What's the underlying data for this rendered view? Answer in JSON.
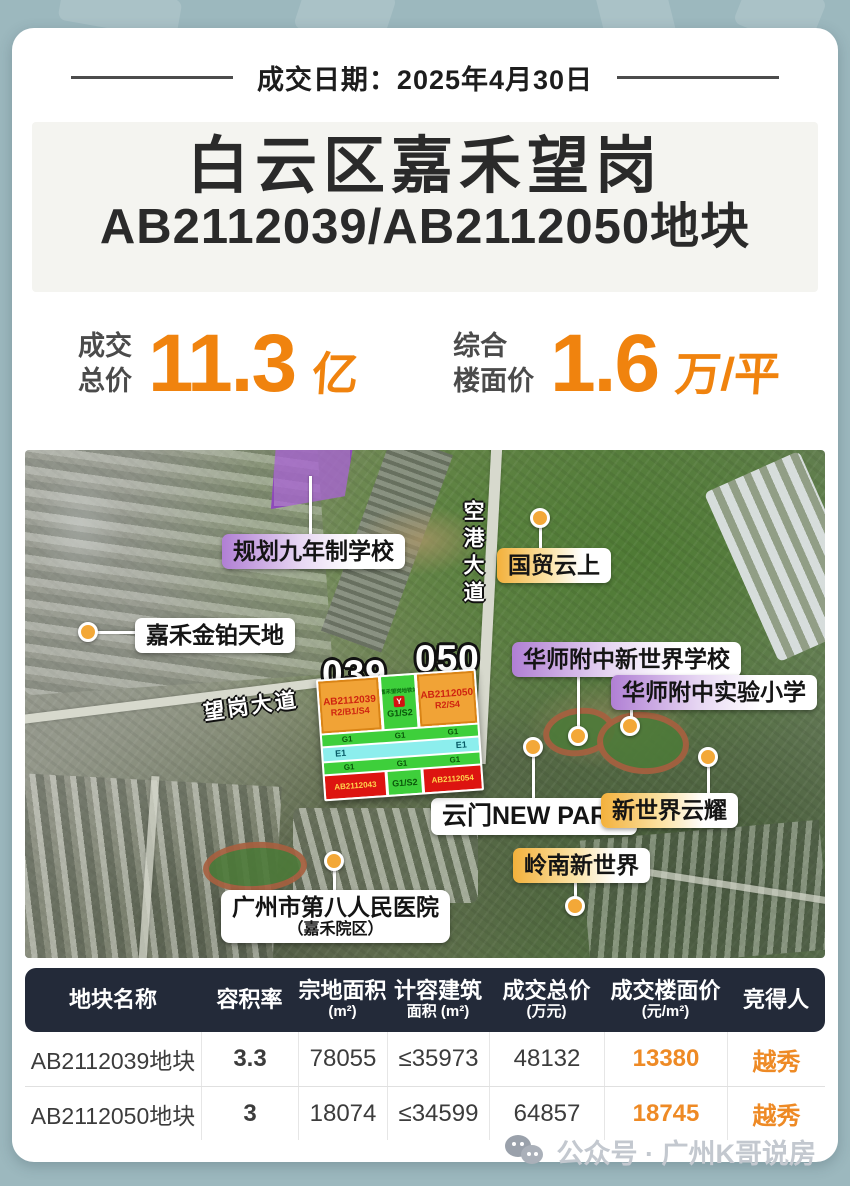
{
  "header": {
    "date_label": "成交日期：2025年4月30日"
  },
  "title": {
    "line1": "白云区嘉禾望岗",
    "line2": "AB2112039/AB2112050地块"
  },
  "metrics": {
    "total": {
      "label_line1": "成交",
      "label_line2": "总价",
      "value": "11.3",
      "unit": "亿"
    },
    "floor": {
      "label_line1": "综合",
      "label_line2": "楼面价",
      "value": "1.6",
      "unit": "万/平"
    }
  },
  "map": {
    "parcel_tags": {
      "left": "039",
      "right": "050"
    },
    "roads": {
      "wanggang": "望岗大道",
      "konggang": "空港大道"
    },
    "labels": {
      "planned_school": "规划九年制学校",
      "guomao_yunshang": "国贸云上",
      "jiahe_jinbo": "嘉禾金铂天地",
      "hsfz_new_world": "华师附中新世界学校",
      "hsfz_primary": "华师附中实验小学",
      "yunmen_new_park": "云门NEW PARK",
      "new_world_yunyao": "新世界云耀",
      "lingnan_new_world": "岭南新世界",
      "hospital": "广州市第八人民医院",
      "hospital_sub": "（嘉禾院区）"
    },
    "inset": {
      "station": "嘉禾望岗地铁站",
      "metro_icon": "Y",
      "p039_code": "AB2112039",
      "p039_zone": "R2/B1/S4",
      "p050_code": "AB2112050",
      "p050_zone": "R2/S4",
      "mid_zone": "G1/S2",
      "g1": "G1",
      "e1": "E1",
      "bottom_left_code": "AB2112043",
      "bottom_mid_zone": "G1/S2",
      "bottom_right_code": "AB2112054"
    }
  },
  "table": {
    "headers": [
      {
        "l1": "地块名称",
        "l2": ""
      },
      {
        "l1": "容积率",
        "l2": ""
      },
      {
        "l1": "宗地面积",
        "l2": "(m²)"
      },
      {
        "l1": "计容建筑",
        "l2": "面积 (m²)"
      },
      {
        "l1": "成交总价",
        "l2": "(万元)"
      },
      {
        "l1": "成交楼面价",
        "l2": "(元/m²)"
      },
      {
        "l1": "竞得人",
        "l2": ""
      }
    ],
    "rows": [
      {
        "name": "AB2112039地块",
        "far": "3.3",
        "site_area": "78055",
        "gfa": "≤35973",
        "price": "48132",
        "floor_price": "13380",
        "winner": "越秀"
      },
      {
        "name": "AB2112050地块",
        "far": "3",
        "site_area": "18074",
        "gfa": "≤34599",
        "price": "64857",
        "floor_price": "18745",
        "winner": "越秀"
      }
    ]
  },
  "footer": {
    "watermark": "公众号 · 广州K哥说房"
  },
  "colors": {
    "accent_orange": "#f0830e",
    "table_header_bg": "#232a39",
    "purple": "#a864d2",
    "gold": "#f3b13c",
    "dot": "#f3a838",
    "background": "#9cb8be"
  }
}
